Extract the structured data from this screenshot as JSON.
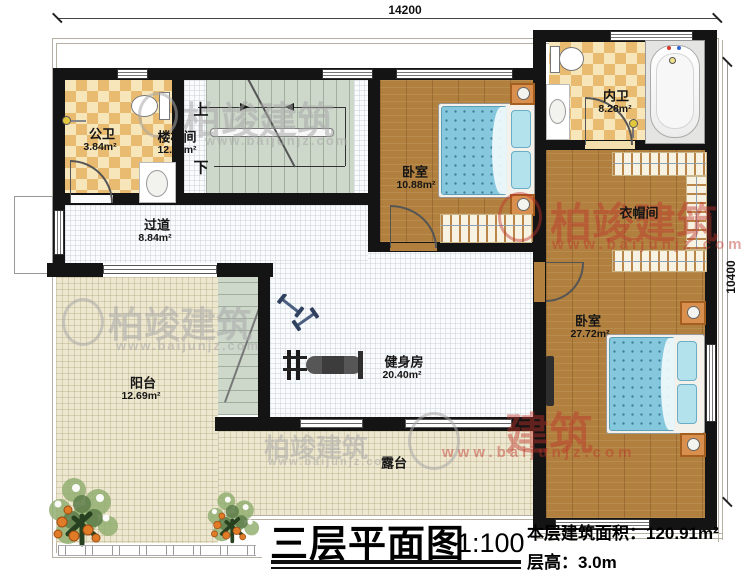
{
  "dimensions": {
    "top": "14200",
    "right": "10400"
  },
  "rooms": {
    "gongwei": {
      "name": "公卫",
      "area": "3.84m²"
    },
    "loutijian": {
      "name": "楼梯间",
      "area": "12.00m²"
    },
    "stair_up": "上",
    "stair_down": "下",
    "bedroom1": {
      "name": "卧室",
      "area": "10.88m²"
    },
    "neiwei": {
      "name": "内卫",
      "area": "8.28m²"
    },
    "yimaojian": {
      "name": "衣帽间"
    },
    "bedroom2": {
      "name": "卧室",
      "area": "27.72m²"
    },
    "guodao": {
      "name": "过道",
      "area": "8.84m²"
    },
    "yangtai": {
      "name": "阳台",
      "area": "12.69m²"
    },
    "jianshenfang": {
      "name": "健身房",
      "area": "20.40m²"
    },
    "lutai": {
      "name": "露台"
    }
  },
  "titleblock": {
    "title": "三层平面图",
    "scale": "1:100",
    "metrics": [
      {
        "label": "本层建筑面积：",
        "value": "120.91m²"
      },
      {
        "label": "层高：",
        "value": "3.0m"
      }
    ]
  },
  "watermarks": {
    "brand": "柏竣建筑",
    "brand_partial": "建筑",
    "url": "www.baijunjz.com"
  },
  "colors": {
    "wall": "#141414",
    "wood": "#b1803f",
    "tile_light": "#f7e6ba",
    "tile_dark": "#e8bb70",
    "stair": "#cdd7ca",
    "terrace": "#eee7cf",
    "bed": "#85c8de",
    "watermark_red": "#be322a"
  }
}
